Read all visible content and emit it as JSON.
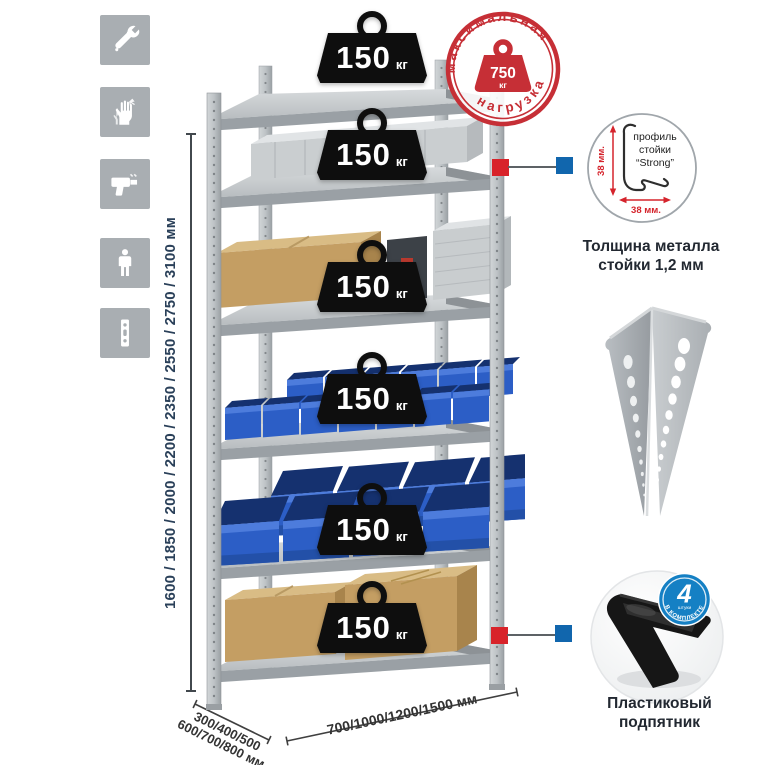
{
  "left_panel": {
    "icons": [
      {
        "name": "wrench-icon"
      },
      {
        "name": "gloves-icon"
      },
      {
        "name": "drill-icon"
      },
      {
        "name": "person-icon"
      },
      {
        "name": "post-strip-icon"
      }
    ],
    "height_dimensions": "1600 / 1850 / 2000 / 2200 / 2350 / 2550 / 2750 / 3100 мм"
  },
  "rack": {
    "shelf_count": 6,
    "shelf_loads": [
      {
        "value": "150",
        "unit": "кг"
      },
      {
        "value": "150",
        "unit": "кг"
      },
      {
        "value": "150",
        "unit": "кг"
      },
      {
        "value": "150",
        "unit": "кг"
      },
      {
        "value": "150",
        "unit": "кг"
      },
      {
        "value": "150",
        "unit": "кг"
      }
    ],
    "max_load_stamp": {
      "arc_top": "максимальная",
      "arc_bottom": "нагрузка",
      "value": "750",
      "unit": "кг"
    }
  },
  "callouts": {
    "profile": {
      "line1": "профиль",
      "line2": "стойки",
      "line3": "“Strong”",
      "dim_vertical": "38 мм.",
      "dim_horizontal": "38 мм.",
      "caption_line1": "Толщина металла",
      "caption_line2": "стойки 1,2 мм"
    },
    "foot": {
      "badge_value": "4",
      "badge_word": "штуки",
      "badge_arc": "В КОМПЛЕКТЕ",
      "caption_line1": "Пластиковый",
      "caption_line2": "подпятник"
    }
  },
  "base_dimensions": {
    "depth_line1": "300/400/500",
    "depth_line2": "600/700/800 мм",
    "width": "700/1000/1200/1500 мм"
  },
  "colors": {
    "stamp_red": "#c62f36",
    "bin_blue": "#2c5ec6",
    "badge_blue": "#1580c4",
    "marker_red": "#d8232a",
    "marker_blue": "#1166ad",
    "metal_gray": "#b5babd",
    "icon_tile_gray": "#a9aeb2",
    "dim_text_navy": "#2a4059",
    "weight_black": "#0e0e0e"
  }
}
